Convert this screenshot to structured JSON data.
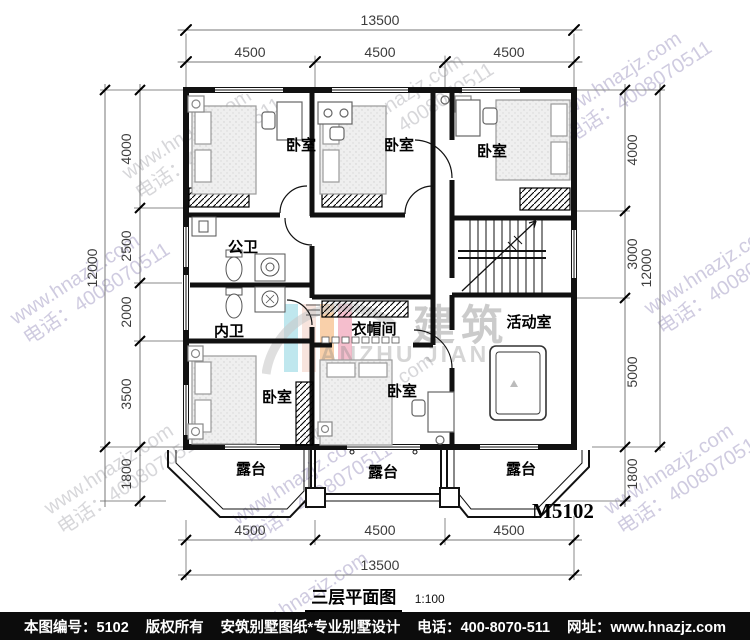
{
  "meta": {
    "plan_code": "M5102",
    "title": "三层平面图",
    "scale": "1:100"
  },
  "dimensions": {
    "top": {
      "overall": "13500",
      "segments": [
        "4500",
        "4500",
        "4500"
      ]
    },
    "bottom": {
      "overall": "13500",
      "segments": [
        "4500",
        "4500",
        "4500"
      ]
    },
    "left": {
      "overall": "12000",
      "segments": [
        "4000",
        "2500",
        "2000",
        "3500",
        "1800"
      ]
    },
    "right": {
      "overall": "12000",
      "segments": [
        "4000",
        "3000",
        "5000",
        "1800"
      ]
    }
  },
  "rooms": {
    "bedroom_top_left": "卧室",
    "bedroom_top_mid": "卧室",
    "bedroom_top_right": "卧室",
    "public_bath": "公卫",
    "inner_bath": "内卫",
    "cloakroom": "衣帽间",
    "bedroom_bottom_left": "卧室",
    "bedroom_bottom_mid": "卧室",
    "activity_room": "活动室",
    "terrace_left": "露台",
    "terrace_mid": "露台",
    "terrace_right": "露台"
  },
  "watermark": {
    "site": "www.hnazjz.com",
    "phone": "电话：4008070511",
    "logo_cn": "建筑",
    "logo_latin": "ANZHU JIANZHU",
    "logo_colors": [
      "#aadfe8",
      "#f6dbd2",
      "#f7c08d",
      "#f2a8bc"
    ]
  },
  "footer": {
    "serial": "本图编号：5102",
    "copyright": "版权所有",
    "studio": "安筑别墅图纸*专业别墅设计",
    "phone": "电话：400-8070-511",
    "site": "网址：www.hnazjz.com"
  }
}
